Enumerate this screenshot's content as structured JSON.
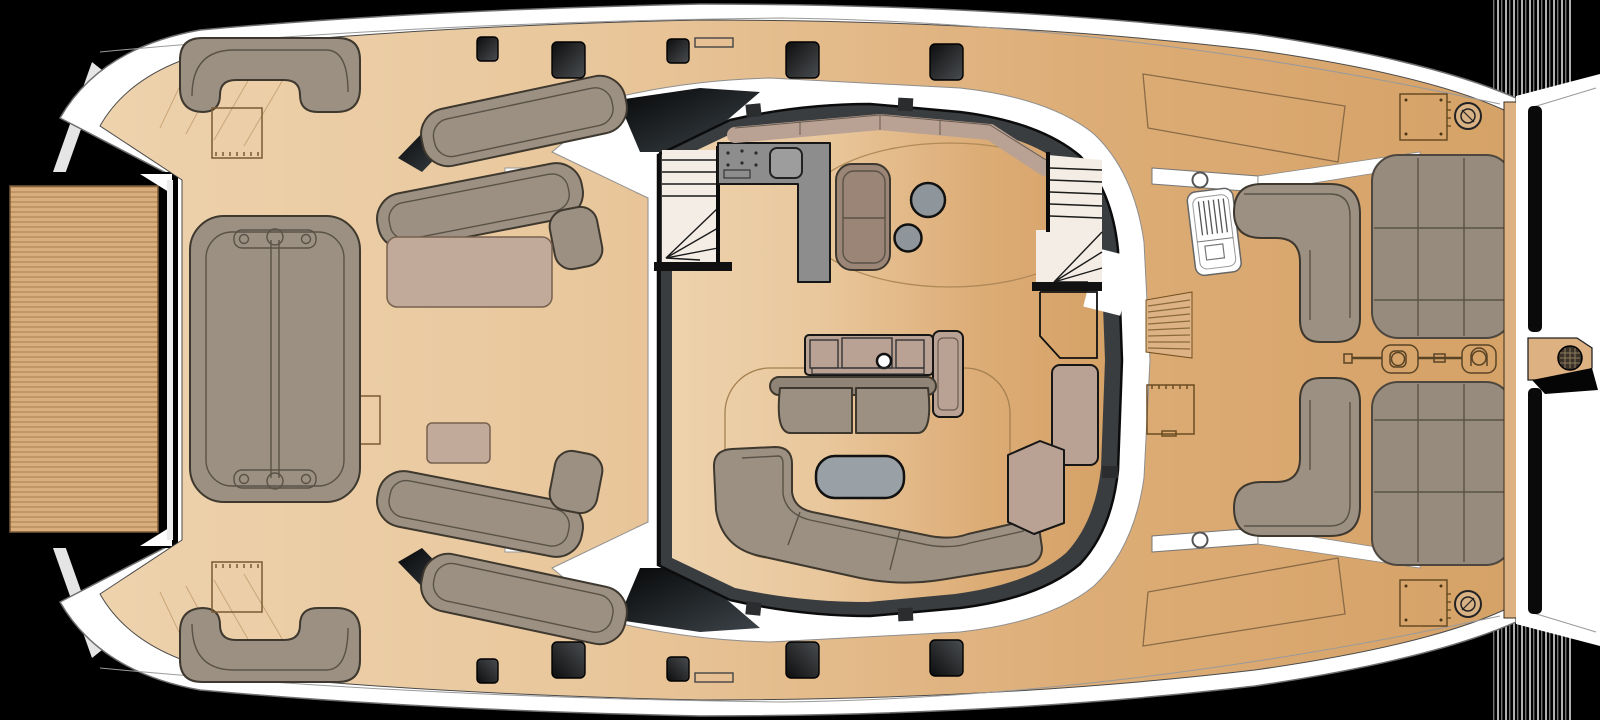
{
  "plan": {
    "type": "catamaran-main-deck-floor-plan",
    "orientation": "bow-left-stern-right"
  },
  "palette": {
    "background": "#000000",
    "hull_white": "#ffffff",
    "trampoline": "#d9ae7c",
    "sofa": "#9b9082",
    "pad_mauve": "#c2aa9b",
    "cabinet_mauve": "#b9a294",
    "chair_brown": "#9a8576",
    "counter_gray": "#8d8d8d",
    "table_gray": "#8e969b",
    "coffee_gray": "#99a1a7",
    "roof_band": "#3a3d40",
    "sunpad": "#968b7d",
    "hatch_dark": "#2a2c2e",
    "stair_white": "#f3ede5",
    "console_white": "#ffffff"
  },
  "regions": [
    {
      "name": "bow-trampoline"
    },
    {
      "name": "foredeck-lounge"
    },
    {
      "name": "port-chaise-area"
    },
    {
      "name": "starboard-chaise-area"
    },
    {
      "name": "salon"
    },
    {
      "name": "galley-counter"
    },
    {
      "name": "stairwell-port"
    },
    {
      "name": "stairwell-starboard"
    },
    {
      "name": "aft-cockpit"
    },
    {
      "name": "helm-console"
    },
    {
      "name": "stern-sunpads"
    },
    {
      "name": "swim-platform"
    }
  ]
}
